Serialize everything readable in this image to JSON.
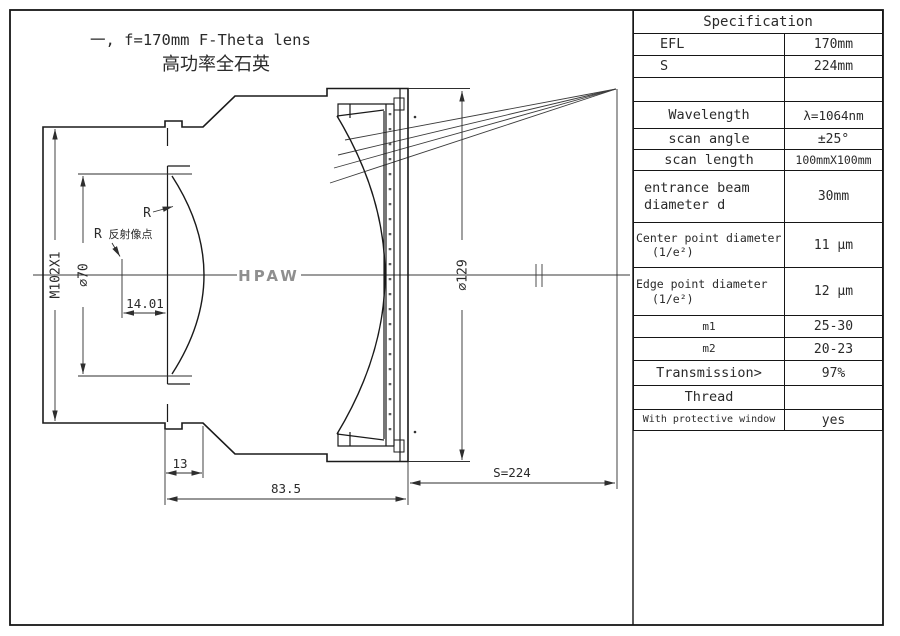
{
  "page": {
    "title_line1": "一, f=170mm F-Theta lens",
    "title_line2": "高功率全石英"
  },
  "drawing": {
    "labels": {
      "hpaw": "HPAW",
      "r": "R",
      "r_reflect_r": "R",
      "r_reflect_cjk": " 反射像点",
      "dim_14_01": "14.01",
      "dim_m102": "M102X1",
      "dim_phi70": "⌀70",
      "dim_phi129": "⌀129",
      "dim_13": "13",
      "dim_83_5": "83.5",
      "dim_s224": "S=224"
    },
    "colors": {
      "line": "#1a1a1a",
      "dim": "#2e2e2e",
      "ray": "#3c3c3c",
      "hpaw_gray": "#8f8f8f"
    }
  },
  "table": {
    "header": "Specification",
    "rows": [
      {
        "name": "efl",
        "h": 22,
        "label_lines": [
          "EFL"
        ],
        "pads": [
          26
        ],
        "value": "170mm"
      },
      {
        "name": "s",
        "h": 22,
        "label_lines": [
          "S"
        ],
        "pads": [
          26
        ],
        "value": "224mm"
      },
      {
        "name": "blank",
        "h": 24,
        "label_lines": [
          ""
        ],
        "value": ""
      },
      {
        "name": "wavelength",
        "h": 27,
        "align": "center",
        "label_lines": [
          "Wavelength"
        ],
        "value": "λ=1064nm",
        "value_size": 12.5
      },
      {
        "name": "scan-angle",
        "h": 21,
        "align": "center",
        "label_lines": [
          "scan angle"
        ],
        "value": "±25°"
      },
      {
        "name": "scan-length",
        "h": 21,
        "align": "center",
        "label_lines": [
          "scan length"
        ],
        "value": "100mmX100mm",
        "value_size": 11.5
      },
      {
        "name": "entrance-beam",
        "h": 52,
        "label_lines": [
          "entrance beam",
          "diameter d"
        ],
        "pads": [
          10,
          10
        ],
        "value": "30mm"
      },
      {
        "name": "center-point",
        "h": 45,
        "label_lines": [
          "Center point diameter",
          "(1/e²)"
        ],
        "pads": [
          2,
          18
        ],
        "label_size": 11.5,
        "value": "11 μm"
      },
      {
        "name": "edge-point",
        "h": 48,
        "label_lines": [
          "Edge point diameter",
          "(1/e²)"
        ],
        "pads": [
          2,
          18
        ],
        "label_size": 11.5,
        "value": "12 μm"
      },
      {
        "name": "m1",
        "h": 22,
        "align": "center",
        "label_lines": [
          "m1"
        ],
        "label_size": 11,
        "value": "25-30"
      },
      {
        "name": "m2",
        "h": 23,
        "align": "center",
        "label_lines": [
          "m2"
        ],
        "label_size": 11,
        "value": "20-23"
      },
      {
        "name": "transmission",
        "h": 25,
        "align": "center",
        "label_lines": [
          "Transmission>"
        ],
        "value": "97%"
      },
      {
        "name": "thread",
        "h": 24,
        "align": "center",
        "label_lines": [
          "Thread"
        ],
        "value": ""
      },
      {
        "name": "protective-window",
        "h": 22,
        "align": "center",
        "label_lines": [
          "With protective window"
        ],
        "label_size": 10,
        "value": "yes"
      }
    ]
  }
}
